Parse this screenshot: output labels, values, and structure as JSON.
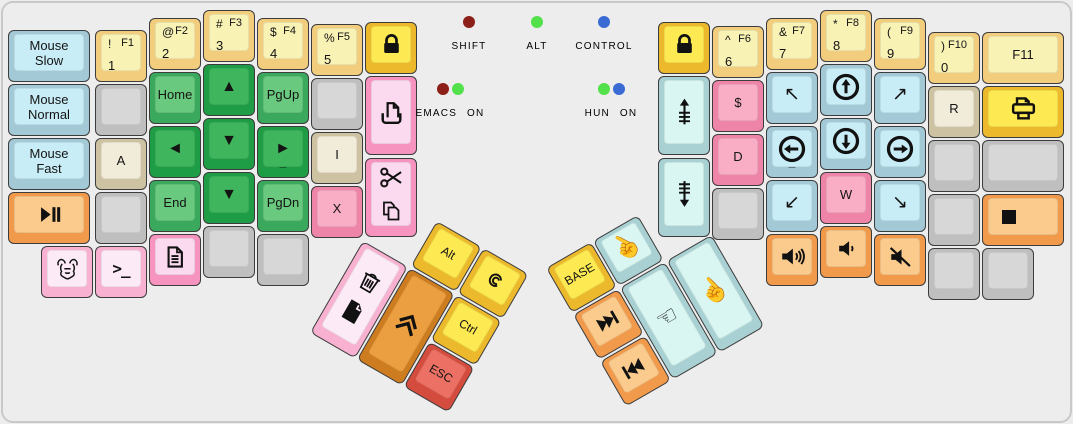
{
  "canvas": {
    "width": 1073,
    "height": 424,
    "background": "#ededed",
    "frame_color": "#c9c9c9"
  },
  "palette": {
    "gold": {
      "top": "#fde951",
      "side": "#ecb92c"
    },
    "lyellow": {
      "top": "#f8f2b5",
      "side": "#f3cd7e"
    },
    "green": {
      "top": "#3fb65d",
      "side": "#1f9d46"
    },
    "greenlt": {
      "top": "#69c97f",
      "side": "#3aa85d"
    },
    "blue": {
      "top": "#c9edf6",
      "side": "#a3c9d6"
    },
    "paleblue": {
      "top": "#d9f6f2",
      "side": "#a9d1d3"
    },
    "pink": {
      "top": "#f9aec6",
      "side": "#ee84a8"
    },
    "pinklt": {
      "top": "#fcebf7",
      "side": "#f8b1d1"
    },
    "pinkmed": {
      "top": "#fbd9ee",
      "side": "#f693be"
    },
    "orange": {
      "top": "#fbcb8d",
      "side": "#f29a4b"
    },
    "orangedeep": {
      "top": "#ec9f41",
      "side": "#cd7c20"
    },
    "red": {
      "top": "#ec7164",
      "side": "#d44c3e"
    },
    "beige": {
      "top": "#f1ecda",
      "side": "#cdc3a3"
    },
    "gray": {
      "top": "#d7d7d7",
      "side": "#bfbfbf"
    }
  },
  "led_colors": {
    "red": "#8c2018",
    "green": "#53e14b",
    "blue": "#3a6ad4"
  },
  "indicators": [
    {
      "n": "shift-indicator",
      "label": "SHIFT",
      "cx": 469,
      "top": 16,
      "dots": [
        "red"
      ]
    },
    {
      "n": "alt-indicator",
      "label": "ALT",
      "cx": 537,
      "top": 16,
      "dots": [
        "green"
      ]
    },
    {
      "n": "control-indicator",
      "label": "CONTROL",
      "cx": 604,
      "top": 16,
      "dots": [
        "blue"
      ]
    },
    {
      "n": "emacs-indicator",
      "label": "EMACS ON",
      "cx": 450,
      "top": 83,
      "dots": [
        "red",
        "green"
      ]
    },
    {
      "n": "hun-indicator",
      "label": "HUN ON",
      "cx": 611,
      "top": 83,
      "dots": [
        "green",
        "blue"
      ]
    }
  ],
  "left_main": [
    {
      "n": "mouse-slow",
      "x": 8,
      "y": 30,
      "w": 82,
      "c": "blue",
      "cc": "Mouse\nSlow"
    },
    {
      "n": "mouse-normal",
      "x": 8,
      "y": 84,
      "w": 82,
      "c": "blue",
      "cc": "Mouse\nNormal"
    },
    {
      "n": "mouse-fast",
      "x": 8,
      "y": 138,
      "w": 82,
      "c": "blue",
      "cc": "Mouse\nFast"
    },
    {
      "n": "play-pause",
      "x": 8,
      "y": 192,
      "w": 82,
      "c": "orange",
      "icon": "play-pause"
    },
    {
      "n": "f1-1",
      "x": 95,
      "y": 30,
      "c": "lyellow",
      "tl": "!",
      "tr": "F1",
      "ml": "1"
    },
    {
      "n": "blank",
      "x": 95,
      "y": 84,
      "c": "gray"
    },
    {
      "n": "a",
      "x": 95,
      "y": 138,
      "c": "beige",
      "cc": "A"
    },
    {
      "n": "blank",
      "x": 95,
      "y": 192,
      "c": "gray"
    },
    {
      "n": "gnu",
      "x": 41,
      "y": 246,
      "c": "pinklt",
      "icon": "gnu"
    },
    {
      "n": "terminal",
      "x": 95,
      "y": 246,
      "c": "pinklt",
      "icon": "terminal"
    },
    {
      "n": "f2-2",
      "x": 149,
      "y": 18,
      "c": "lyellow",
      "tl": "@",
      "tr": "F2",
      "ml": "2"
    },
    {
      "n": "home",
      "x": 149,
      "y": 72,
      "c": "greenlt",
      "cc": "Home"
    },
    {
      "n": "arrow-left",
      "x": 149,
      "y": 126,
      "c": "green",
      "cc": "◄",
      "fs": 16
    },
    {
      "n": "end",
      "x": 149,
      "y": 180,
      "c": "greenlt",
      "cc": "End"
    },
    {
      "n": "document",
      "x": 149,
      "y": 234,
      "c": "pinkmed",
      "icon": "document"
    },
    {
      "n": "f3-3",
      "x": 203,
      "y": 10,
      "c": "lyellow",
      "tl": "#",
      "tr": "F3",
      "ml": "3"
    },
    {
      "n": "arrow-up",
      "x": 203,
      "y": 64,
      "c": "green",
      "cc": "▲",
      "fs": 16
    },
    {
      "n": "arrow-down",
      "x": 203,
      "y": 118,
      "c": "green",
      "cc": "▼",
      "fs": 16
    },
    {
      "n": "arrow-down-2",
      "x": 203,
      "y": 172,
      "c": "green",
      "cc": "▼",
      "fs": 16
    },
    {
      "n": "blank",
      "x": 203,
      "y": 226,
      "c": "gray"
    },
    {
      "n": "f4-4",
      "x": 257,
      "y": 18,
      "c": "lyellow",
      "tl": "$",
      "tr": "F4",
      "ml": "4"
    },
    {
      "n": "pgup",
      "x": 257,
      "y": 72,
      "c": "greenlt",
      "cc": "PgUp"
    },
    {
      "n": "arrow-right",
      "x": 257,
      "y": 126,
      "c": "green",
      "cc": "►",
      "fs": 16,
      "sub": "_"
    },
    {
      "n": "pgdn",
      "x": 257,
      "y": 180,
      "c": "greenlt",
      "cc": "PgDn"
    },
    {
      "n": "blank",
      "x": 257,
      "y": 234,
      "c": "gray"
    },
    {
      "n": "f5-5",
      "x": 311,
      "y": 24,
      "c": "lyellow",
      "tl": "%",
      "tr": "F5",
      "ml": "5"
    },
    {
      "n": "blank",
      "x": 311,
      "y": 78,
      "c": "gray"
    },
    {
      "n": "i",
      "x": 311,
      "y": 132,
      "c": "beige",
      "cc": "I"
    },
    {
      "n": "x",
      "x": 311,
      "y": 186,
      "c": "pink",
      "cc": "X"
    },
    {
      "n": "lock-left",
      "x": 365,
      "y": 22,
      "c": "gold",
      "icon": "lock"
    },
    {
      "n": "paste",
      "x": 365,
      "y": 76,
      "h": 79,
      "c": "pinkmed",
      "icon": "paste"
    },
    {
      "n": "cut-copy",
      "x": 365,
      "y": 158,
      "h": 79,
      "c": "pinkmed",
      "icons": [
        "cut",
        "copy"
      ]
    }
  ],
  "right_main": [
    {
      "n": "lock-right",
      "x": 658,
      "y": 22,
      "c": "gold",
      "icon": "lock"
    },
    {
      "n": "scroll-up",
      "x": 658,
      "y": 76,
      "h": 79,
      "c": "paleblue",
      "icon": "scroll-up"
    },
    {
      "n": "scroll-down",
      "x": 658,
      "y": 158,
      "h": 79,
      "c": "paleblue",
      "icon": "scroll-down"
    },
    {
      "n": "f6-6",
      "x": 712,
      "y": 26,
      "c": "lyellow",
      "tl": "^",
      "tr": "F6",
      "ml": "6"
    },
    {
      "n": "dollar",
      "x": 712,
      "y": 80,
      "c": "pink",
      "cc": "$"
    },
    {
      "n": "d",
      "x": 712,
      "y": 134,
      "c": "pink",
      "cc": "D"
    },
    {
      "n": "blank",
      "x": 712,
      "y": 188,
      "c": "gray"
    },
    {
      "n": "f7-7",
      "x": 766,
      "y": 18,
      "c": "lyellow",
      "tl": "&",
      "tr": "F7",
      "ml": "7"
    },
    {
      "n": "mouse-up-left",
      "x": 766,
      "y": 72,
      "c": "blue",
      "cc": "↖",
      "fs": 19
    },
    {
      "n": "circle-left-key",
      "x": 766,
      "y": 126,
      "c": "blue",
      "icon": "circle-left",
      "sub": "_"
    },
    {
      "n": "mouse-down-left",
      "x": 766,
      "y": 180,
      "c": "blue",
      "cc": "↙",
      "fs": 19
    },
    {
      "n": "volume-up",
      "x": 766,
      "y": 234,
      "c": "orange",
      "icon": "vol-up"
    },
    {
      "n": "f8-8",
      "x": 820,
      "y": 10,
      "c": "lyellow",
      "tl": "*",
      "tr": "F8",
      "ml": "8"
    },
    {
      "n": "circle-up-key",
      "x": 820,
      "y": 64,
      "c": "blue",
      "icon": "circle-up"
    },
    {
      "n": "circle-down-key",
      "x": 820,
      "y": 118,
      "c": "blue",
      "icon": "circle-down"
    },
    {
      "n": "w",
      "x": 820,
      "y": 172,
      "c": "pink",
      "cc": "W"
    },
    {
      "n": "volume-down",
      "x": 820,
      "y": 226,
      "c": "orange",
      "icon": "vol-down"
    },
    {
      "n": "f9-9",
      "x": 874,
      "y": 18,
      "c": "lyellow",
      "tl": "(",
      "tr": "F9",
      "ml": "9"
    },
    {
      "n": "mouse-up-right",
      "x": 874,
      "y": 72,
      "c": "blue",
      "cc": "↗",
      "fs": 19
    },
    {
      "n": "circle-right-key",
      "x": 874,
      "y": 126,
      "c": "blue",
      "icon": "circle-right"
    },
    {
      "n": "mouse-down-right",
      "x": 874,
      "y": 180,
      "c": "blue",
      "cc": "↘",
      "fs": 19
    },
    {
      "n": "volume-mute",
      "x": 874,
      "y": 234,
      "c": "orange",
      "icon": "vol-mute"
    },
    {
      "n": "f10-0",
      "x": 928,
      "y": 32,
      "c": "lyellow",
      "tl": ")",
      "tr": "F10",
      "ml": "0"
    },
    {
      "n": "r",
      "x": 928,
      "y": 86,
      "c": "beige",
      "cc": "R"
    },
    {
      "n": "blank",
      "x": 928,
      "y": 140,
      "c": "gray"
    },
    {
      "n": "blank",
      "x": 928,
      "y": 194,
      "c": "gray"
    },
    {
      "n": "blank",
      "x": 928,
      "y": 248,
      "c": "gray"
    },
    {
      "n": "f11",
      "x": 982,
      "y": 32,
      "w": 82,
      "c": "lyellow",
      "cc": "F11"
    },
    {
      "n": "print",
      "x": 982,
      "y": 86,
      "w": 82,
      "c": "gold",
      "icon": "print"
    },
    {
      "n": "blank",
      "x": 982,
      "y": 140,
      "w": 82,
      "c": "gray"
    },
    {
      "n": "media-stop",
      "x": 982,
      "y": 194,
      "w": 82,
      "c": "orange",
      "icon": "stop"
    },
    {
      "n": "blank",
      "x": 982,
      "y": 248,
      "c": "gray"
    }
  ],
  "left_thumb": {
    "origin_x": 390,
    "origin_y": 194,
    "rotation_deg": 30,
    "keys": [
      {
        "n": "alt",
        "x": 54,
        "y": 0,
        "c": "gold",
        "cc": "Alt",
        "fs": 12
      },
      {
        "n": "debian",
        "x": 108,
        "y": 0,
        "c": "gold",
        "icon": "debian"
      },
      {
        "n": "trash-save",
        "x": 0,
        "y": 54,
        "h": 106,
        "c": "pinklt",
        "icons": [
          "trash",
          "file-black"
        ]
      },
      {
        "n": "shift-chevron",
        "x": 54,
        "y": 54,
        "h": 106,
        "c": "orangedeep",
        "icon": "chevrons"
      },
      {
        "n": "ctrl",
        "x": 108,
        "y": 54,
        "c": "gold",
        "cc": "Ctrl",
        "fs": 12
      },
      {
        "n": "esc",
        "x": 108,
        "y": 108,
        "c": "red",
        "cc": "ESC",
        "fs": 12
      }
    ]
  },
  "right_thumb": {
    "origin_x": 546,
    "origin_y": 268,
    "rotation_deg": -30,
    "keys": [
      {
        "n": "base-layer",
        "x": 0,
        "y": 0,
        "c": "gold",
        "cc": "BASE",
        "fs": 12
      },
      {
        "n": "mouse-button-middle",
        "x": 54,
        "y": 0,
        "c": "paleblue",
        "icon": "hand-up"
      },
      {
        "n": "skip-next",
        "x": 0,
        "y": 54,
        "c": "orange",
        "icon": "skip-next"
      },
      {
        "n": "skip-prev",
        "x": 0,
        "y": 108,
        "c": "orange",
        "icon": "skip-prev"
      },
      {
        "n": "mouse-button-left",
        "x": 54,
        "y": 54,
        "h": 106,
        "c": "paleblue",
        "icon": "hand-left"
      },
      {
        "n": "mouse-button-right",
        "x": 108,
        "y": 54,
        "h": 106,
        "c": "paleblue",
        "icon": "hand-up-2"
      }
    ]
  }
}
